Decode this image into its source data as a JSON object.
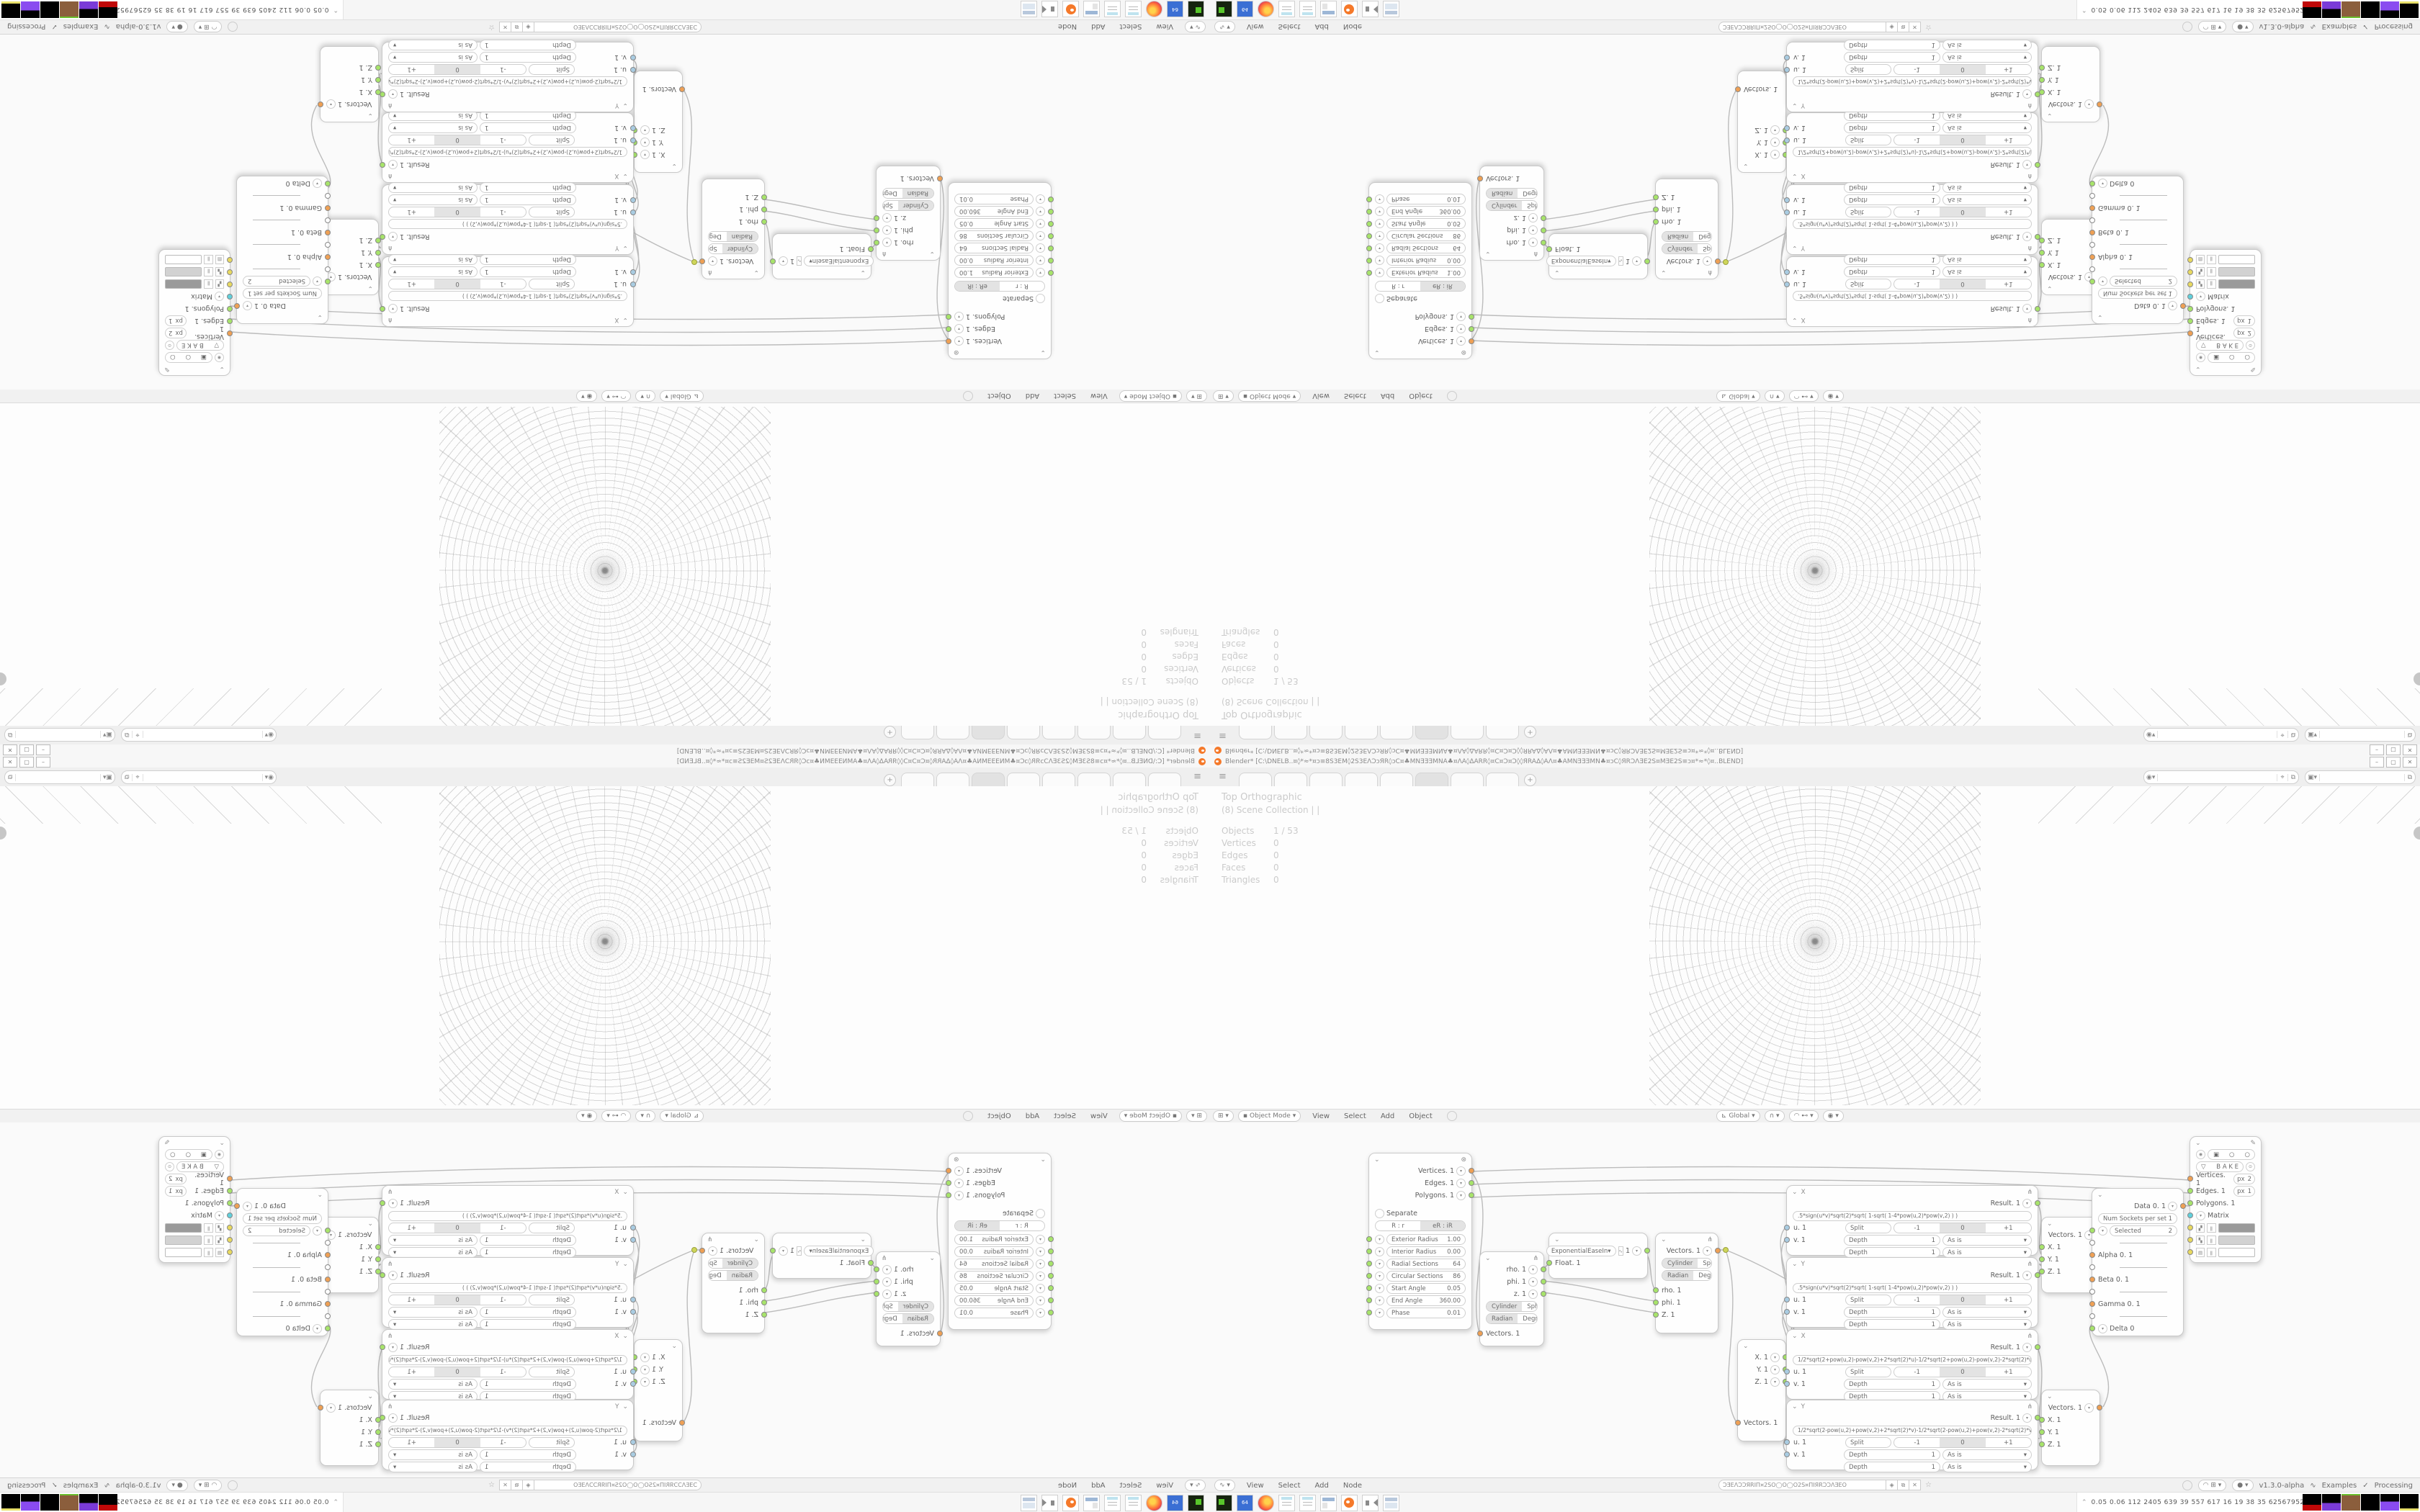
{
  "window": {
    "title": "Blender*  [C:\\DNELB..¤◊*≈*¤ɔ≡8S3EM◊2S3EΛƆɔЯR◊ɔC¤♣MNƎƎƎMNA♣¤ΛA◊ΔARR◊¤C¤Ɔ¤Ɔ◊◊ЯRAΔ◊AΛ¤♣AMNƎƎƎMN♣¤ɔC◊ЯRƆΛƎE2S¤MƎE2S≡ɔ¤*≈*◊¤..BLEND]",
    "minimize": "–",
    "maximize": "▢",
    "close": "✕"
  },
  "topbar": {
    "menu_icon": "≡",
    "new_tab": "+"
  },
  "viewport": {
    "view_label": "Top Orthographic",
    "collection_label": "(8) Scene Collection | |",
    "stats": [
      [
        "Objects",
        "1 / 53"
      ],
      [
        "Vertices",
        "0"
      ],
      [
        "Edges",
        "0"
      ],
      [
        "Faces",
        "0"
      ],
      [
        "Triangles",
        "0"
      ]
    ],
    "header": {
      "mode": "Object Mode",
      "menus": [
        "View",
        "Select",
        "Add",
        "Object"
      ],
      "orientation": "Global"
    }
  },
  "node_editor": {
    "menus": [
      "View",
      "Select",
      "Add",
      "Node"
    ],
    "tree_name": "ƆƎEΛƆƆЯRIΠ¤2SO◯O◯O2S¤ΠIЯRƆƆΛƎEO",
    "version": "v1.3.0-alpha",
    "examples_label": "Examples",
    "check": "✓",
    "processing_label": "Processing"
  },
  "nodes": {
    "torus": {
      "outputs": [
        "Vertices. 1",
        "Edges. 1",
        "Polygons. 1"
      ],
      "separate_label": "Separate",
      "mode_a": "R : r",
      "mode_b": "eR : iR",
      "params": [
        [
          "Exterior Radius",
          "1.00"
        ],
        [
          "Interior Radius",
          "0.00"
        ],
        [
          "Radial Sections",
          "64"
        ],
        [
          "Circular Sections",
          "86"
        ],
        [
          "Start Angle",
          "0.05"
        ],
        [
          "End Angle",
          "360.00"
        ],
        [
          "Phase",
          "0.01"
        ]
      ]
    },
    "polar_out": {
      "outputs": [
        "rho. 1",
        "phi. 1",
        "z. 1"
      ],
      "seg1": [
        "Cylinder",
        "Sphere"
      ],
      "seg2": [
        "Radian",
        "Degree"
      ],
      "input": "Vectors. 1"
    },
    "easing": {
      "mode": "ExponentialEaseIn",
      "value": "1",
      "input": "Float. 1"
    },
    "polar_in": {
      "output": "Vectors. 1",
      "seg1": [
        "Cylinder",
        "Sphere"
      ],
      "seg2": [
        "Radian",
        "Degree"
      ],
      "inputs": [
        "rho. 1",
        "phi. 1",
        "Z. 1"
      ]
    },
    "vec_split": {
      "outputs": [
        "X. 1",
        "Y. 1",
        "Z. 1"
      ],
      "input": "Vectors. 1"
    },
    "formulas": [
      {
        "title": "X",
        "result": "Result. 1",
        "formula": ".5*sign(u*v)*sqrt(2)*sqrt(   1-sqrt(   1-4*pow(u,2)*pow(v,2)   )   )",
        "split": "Split",
        "seg": [
          "-1",
          "0",
          "+1"
        ],
        "depth": "Depth",
        "dval": "1",
        "wrap": "As is",
        "u": "u. 1",
        "v": "v. 1"
      },
      {
        "title": "Y",
        "result": "Result. 1",
        "formula": ".5*sign(u*v)*sqrt(2)*sqrt(   1-sqrt(   1-4*pow(u,2)*pow(v,2)   )   )",
        "split": "Split",
        "seg": [
          "-1",
          "0",
          "+1"
        ],
        "depth": "Depth",
        "dval": "1",
        "wrap": "As is",
        "u": "u. 1",
        "v": "v. 1"
      },
      {
        "title": "X",
        "result": "Result. 1",
        "formula": "1/2*sqrt(2+pow(u,2)-pow(v,2)+2*sqrt(2)*u)-1/2*sqrt(2+pow(u,2)-pow(v,2)-2*sqrt(2)*u)",
        "split": "Split",
        "seg": [
          "-1",
          "0",
          "+1"
        ],
        "depth": "Depth",
        "dval": "1",
        "wrap": "As is",
        "u": "u. 1",
        "v": "v. 1"
      },
      {
        "title": "Y",
        "result": "Result. 1",
        "formula": "1/2*sqrt(2-pow(u,2)+pow(v,2)+2*sqrt(2)*v)-1/2*sqrt(2-pow(u,2)+pow(v,2)-2*sqrt(2)*v)",
        "split": "Split",
        "seg": [
          "-1",
          "0",
          "+1"
        ],
        "depth": "Depth",
        "dval": "1",
        "wrap": "As is",
        "u": "u. 1",
        "v": "v. 1"
      }
    ],
    "vec_join_a": {
      "output": "Vectors. 1",
      "inputs": [
        "X. 1",
        "Y. 1",
        "Z. 1"
      ]
    },
    "vec_join_b": {
      "output": "Vectors. 1",
      "inputs": [
        "X. 1",
        "Y. 1",
        "Z. 1"
      ]
    },
    "list_input": {
      "output": "Data 0. 1",
      "num_label": "Num Sockets per set",
      "num_value": "1",
      "selected_label": "Selected",
      "selected_value": "2",
      "item1": "Alpha 0. 1",
      "item2": "Beta 0. 1",
      "item3": "Gamma 0. 1",
      "item4": "Delta 0"
    },
    "viewer": {
      "bake_label": "B A K E",
      "in1": "Vertices. 1",
      "in1_px": "px",
      "in1_pxv": "2",
      "in2": "Edges. 1",
      "in2_px": "px",
      "in2_pxv": "1",
      "in3": "Polygons. 1",
      "in4": "Matrix"
    }
  },
  "taskbar": {
    "stats": "0.05 0.06  112 2405 639   39   557  617   16    19    38    35  62567952"
  },
  "colors": {
    "socket_vector": "#efa054",
    "socket_data": "#a7e46a",
    "socket_matrix": "#5fd0dc",
    "socket_color": "#e8d95f",
    "accent": "#f5792a"
  }
}
